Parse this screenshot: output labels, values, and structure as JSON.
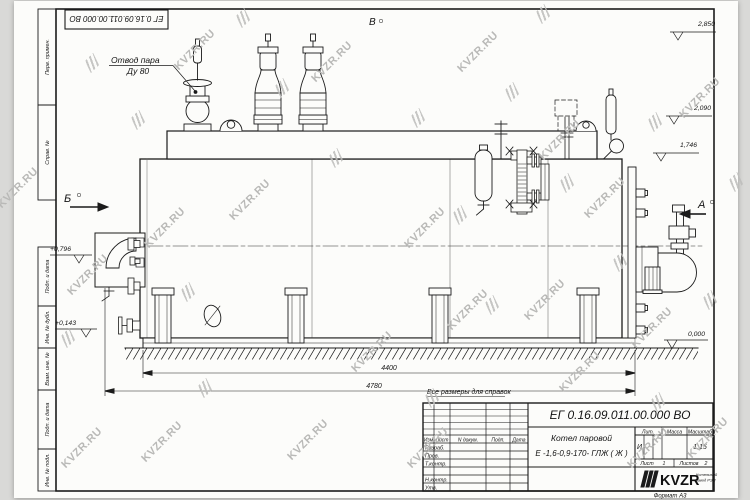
{
  "watermark": {
    "text": "KVZR.RU"
  },
  "corner_stamp": {
    "doc_number": "ЕГ 0.16.09.011.00.000  ВО"
  },
  "margin": {
    "labels": [
      "Перв. примен.",
      "Справ. №",
      "Подп. и дата",
      "Инв. № дубл.",
      "Взам. инв. №",
      "Подп. и дата",
      "Инв. № подл."
    ]
  },
  "drawing": {
    "labels": {
      "steam_outlet_line1": "Отвод пара",
      "steam_outlet_line2": "Ду 80",
      "note": "Все размеры для справок"
    },
    "view_markers": {
      "a": "А",
      "b": "Б",
      "v": "В"
    },
    "elevations": {
      "top": "2,850",
      "drum": "2,090",
      "shell": "1,746",
      "left_upper": "+0,796",
      "left_lower": "+0,143",
      "ground": "0,000"
    },
    "dimensions": {
      "inner": "4400",
      "overall": "4780"
    }
  },
  "title_block": {
    "doc_number": "ЕГ 0.16.09.011.00.000  ВО",
    "product_line1": "Котел паровой",
    "product_line2": "Е -1,6-0,9-170- ГЛЖ ( Ж )",
    "columns": {
      "izm": "Изм",
      "list": "Лист",
      "ndoc": "N докум.",
      "podp": "Подп.",
      "data": "Дата"
    },
    "rows": {
      "razrab": "Разраб.",
      "prov": "Пров.",
      "tkontr": "Т.контр.",
      "nkontr": "Н.контр.",
      "utv": "Утв."
    },
    "lit": {
      "header": "Лит.",
      "value": "И"
    },
    "massa": {
      "header": "Масса"
    },
    "scale": {
      "header": "Масштаб",
      "value": "1:15"
    },
    "sheet": {
      "list_label": "Лист",
      "list_value": "1",
      "listov_label": "Листов",
      "listov_value": "2"
    },
    "logo": {
      "text": "KVZR",
      "caption_line1": "Котельный",
      "caption_line2": "завод РЭП"
    },
    "format": "Формат А3"
  }
}
